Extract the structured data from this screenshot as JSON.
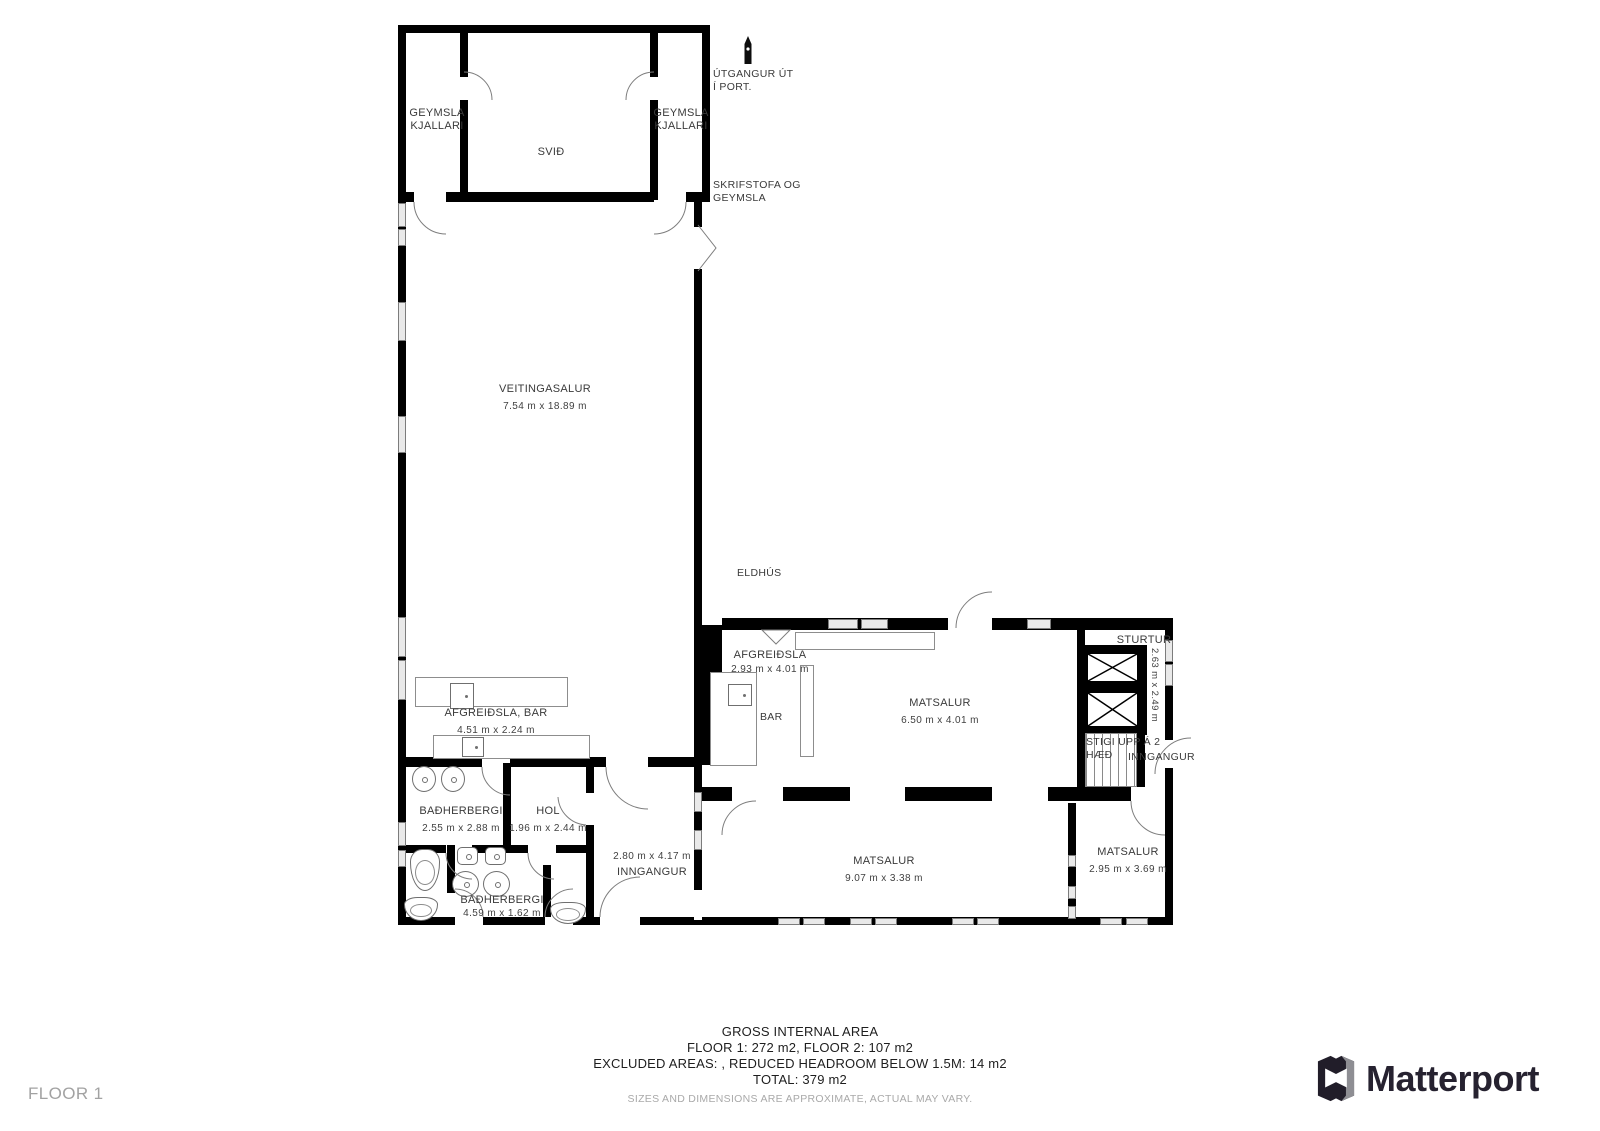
{
  "plan": {
    "floor_tag": "FLOOR 1",
    "annotations": {
      "geymsla_left": {
        "line1": "GEYMSLA",
        "line2": "KJALLARI"
      },
      "geymsla_right": {
        "line1": "GEYMSLA",
        "line2": "KJALLARI"
      },
      "svid": "SVIÐ",
      "utgangur": {
        "line1": "ÚTGANGUR ÚT",
        "line2": "Í PORT."
      },
      "skrifstofa": {
        "line1": "SKRIFSTOFA OG",
        "line2": "GEYMSLA"
      },
      "eldhus": "ELDHÚS",
      "bar": "BAR",
      "stigi": {
        "line1": "STIGI UPP Á 2",
        "line2": "HÆÐ"
      },
      "inngangur_entry": "INNGANGUR"
    },
    "rooms": [
      {
        "name": "VEITINGASALUR",
        "dims": "7.54 m x 18.89 m"
      },
      {
        "name": "AFGREIÐSLA",
        "dims": "2.93 m x 4.01 m"
      },
      {
        "name": "MATSALUR",
        "dims": "6.50 m x 4.01 m"
      },
      {
        "name": "STURTUR",
        "dims": "2.63 m x 2.49 m"
      },
      {
        "name": "AFGREIÐSLA, BAR",
        "dims": "4.51 m x 2.24 m"
      },
      {
        "name": "BAÐHERBERGI",
        "dims": "2.55 m x 2.88 m"
      },
      {
        "name": "HOL",
        "dims": "1.96 m x 2.44 m"
      },
      {
        "name": "INNGANGUR",
        "dims": "2.80 m x 4.17 m"
      },
      {
        "name": "MATSALUR",
        "dims": "9.07 m x 3.38 m"
      },
      {
        "name": "MATSALUR",
        "dims": "2.95 m x 3.69 m"
      },
      {
        "name": "BAÐHERBERGI",
        "dims": "4.59 m x 1.62 m"
      }
    ]
  },
  "footer": {
    "title": "GROSS INTERNAL AREA",
    "line1": "FLOOR 1: 272 m2, FLOOR 2: 107 m2",
    "line2": "EXCLUDED AREAS: , REDUCED HEADROOM BELOW 1.5M: 14 m2",
    "line3": "TOTAL: 379 m2",
    "disclaimer": "SIZES AND DIMENSIONS ARE APPROXIMATE, ACTUAL MAY VARY."
  },
  "brand": {
    "name": "Matterport"
  },
  "colors": {
    "wall": "#000000",
    "label": "#3a3a3a",
    "muted": "#a9a9a9",
    "brand": "#262230"
  }
}
